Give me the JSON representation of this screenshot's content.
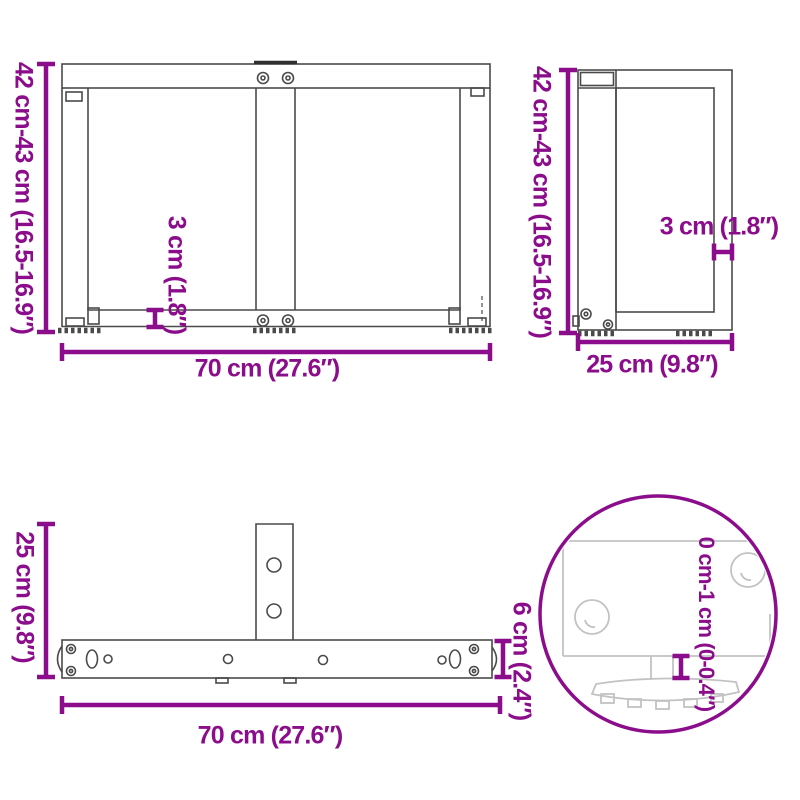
{
  "diagram": {
    "kind": "product-dimension-drawing",
    "subject": "T-shaped table leg – front, side, top views and adjustable foot detail",
    "accent_color": "#8B0D8B",
    "drawing_line_color": "#4a4a4a",
    "detail_line_color": "#c2c2c2",
    "background_color": "#ffffff"
  },
  "labels": {
    "front_height": "42 cm-43 cm (16.5-16.9″)",
    "front_width": "70 cm (27.6″)",
    "front_plate_thickness": "3 cm (1.8″)",
    "side_height": "42 cm-43 cm (16.5-16.9″)",
    "side_depth": "25 cm (9.8″)",
    "side_plate_thickness": "3 cm (1.8″)",
    "top_depth": "25 cm (9.8″)",
    "top_width": "70 cm (27.6″)",
    "top_bar_width": "6 cm (2.4″)",
    "foot_adjustment": "0 cm-1 cm (0-0.4″)"
  }
}
